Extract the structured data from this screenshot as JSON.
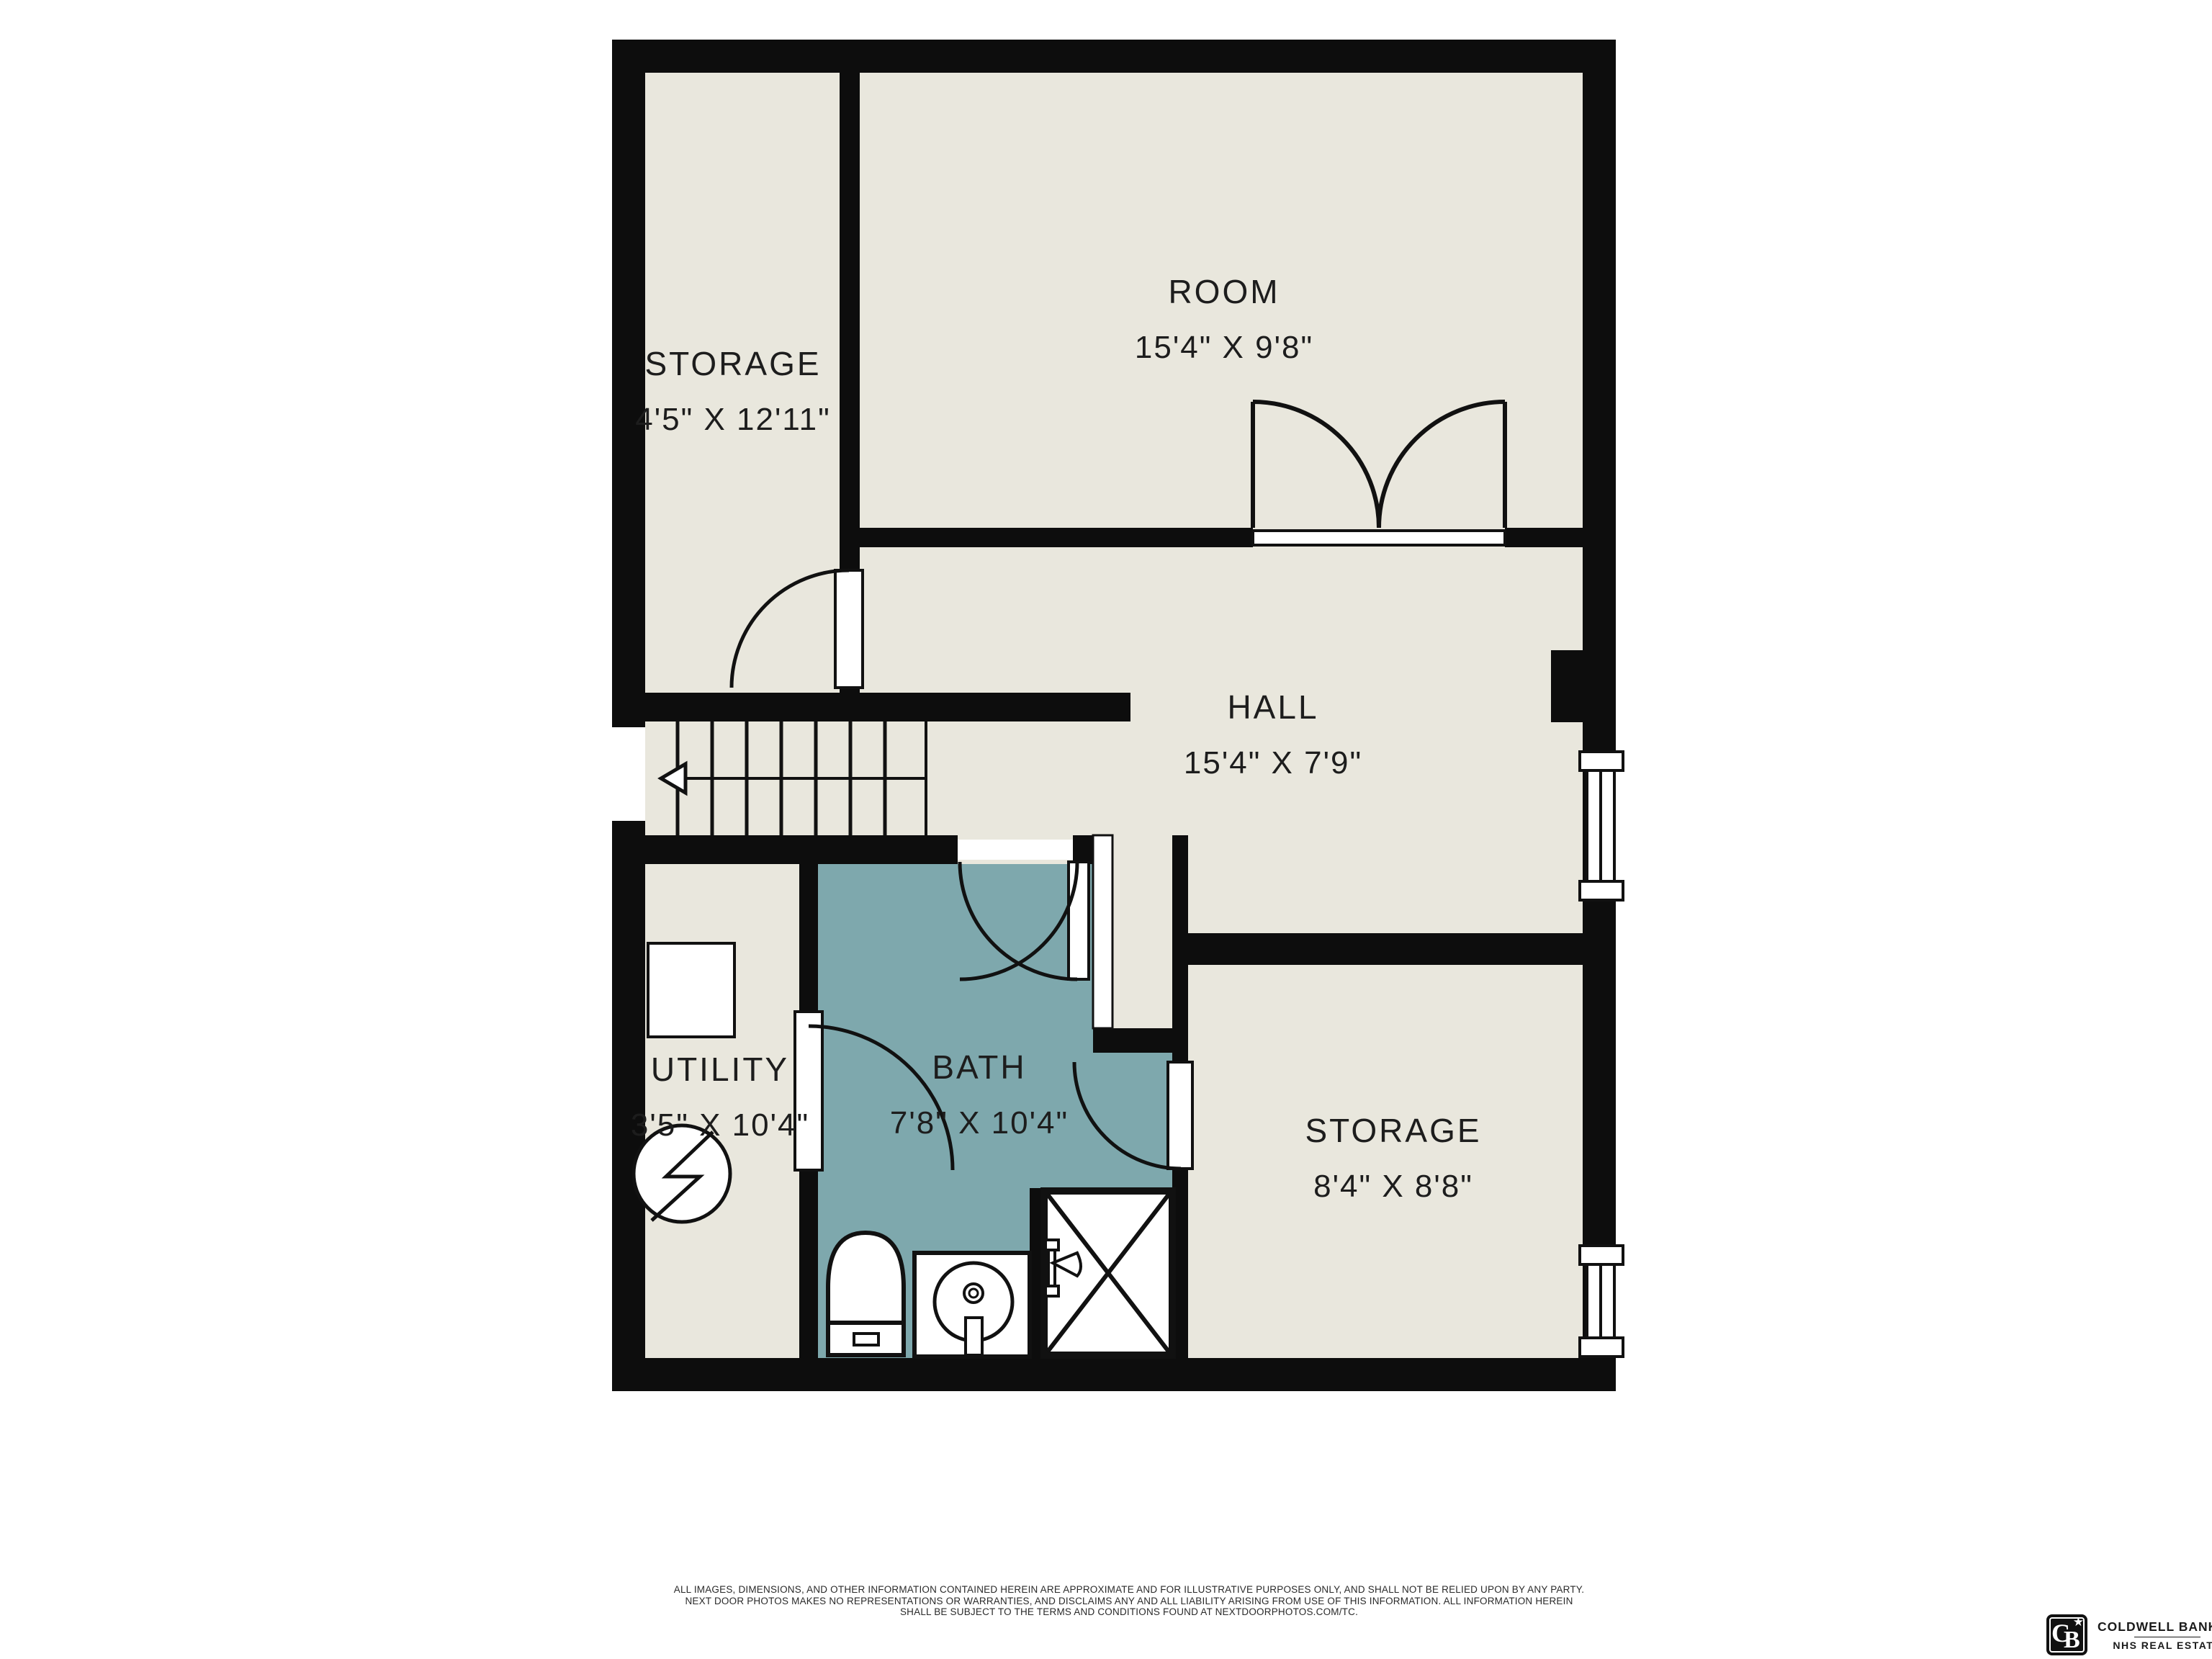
{
  "colors": {
    "wall": "#0d0d0d",
    "floor": "#e9e7dd",
    "bath": "#7ea8ad",
    "line": "#111111",
    "text": "#1d1d1d",
    "bg": "#ffffff"
  },
  "floorplan": {
    "rooms": [
      {
        "id": "storage-top-left",
        "name": "STORAGE",
        "dims": "4'5\" X 12'11\""
      },
      {
        "id": "room",
        "name": "ROOM",
        "dims": "15'4\" X 9'8\""
      },
      {
        "id": "hall",
        "name": "HALL",
        "dims": "15'4\" X 7'9\""
      },
      {
        "id": "utility",
        "name": "UTILITY",
        "dims": "3'5\" X 10'4\""
      },
      {
        "id": "bath",
        "name": "BATH",
        "dims": "7'8\" X 10'4\""
      },
      {
        "id": "storage-bottom-right",
        "name": "STORAGE",
        "dims": "8'4\" X 8'8\""
      }
    ],
    "features": [
      "double-door-room",
      "single-door-storage",
      "bath-door-from-hall",
      "utility-to-bath-door",
      "bath-to-storage-door",
      "stairs-with-down-arrow",
      "window-hall-right-wall",
      "window-storage-right-wall",
      "toilet",
      "sink-vanity",
      "shower",
      "electrical-panel-symbol",
      "appliance-square"
    ]
  },
  "disclaimer": {
    "line1": "ALL IMAGES, DIMENSIONS, AND OTHER INFORMATION CONTAINED HEREIN ARE APPROXIMATE AND FOR ILLUSTRATIVE PURPOSES ONLY, AND SHALL NOT BE RELIED UPON BY ANY PARTY.",
    "line2": "NEXT DOOR PHOTOS MAKES NO REPRESENTATIONS OR WARRANTIES, AND DISCLAIMS ANY AND ALL LIABILITY ARISING FROM USE OF THIS INFORMATION. ALL INFORMATION HEREIN",
    "line3": "SHALL BE SUBJECT TO THE TERMS AND CONDITIONS FOUND AT NEXTDOORPHOTOS.COM/TC."
  },
  "brand": {
    "monogram_c": "C",
    "monogram_b": "B",
    "star": "★",
    "name_line1": "COLDWELL BANKER",
    "name_line2": "NHS REAL ESTATE"
  }
}
